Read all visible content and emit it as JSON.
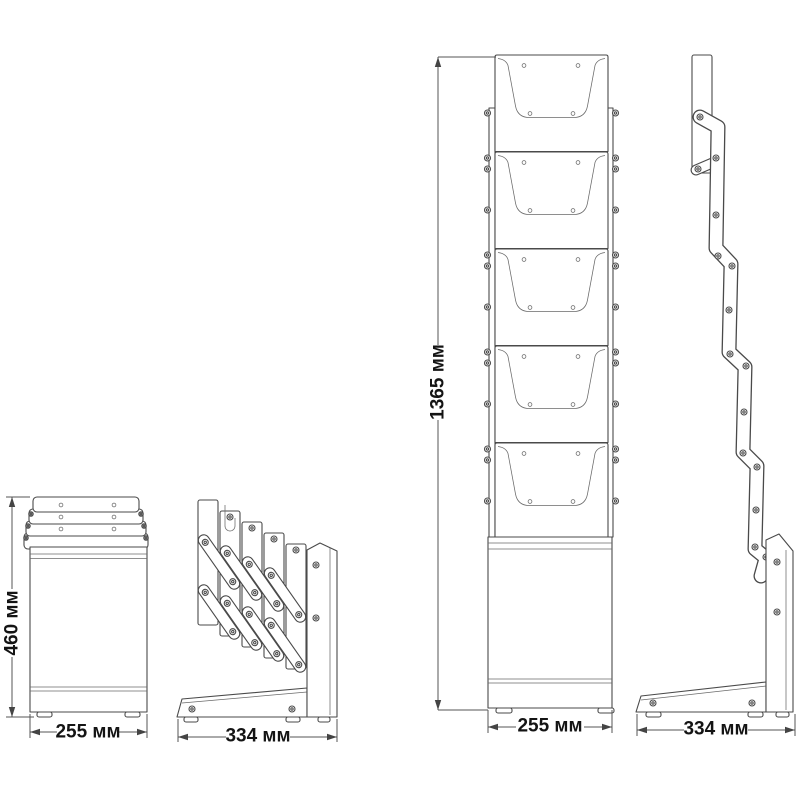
{
  "diagram": {
    "unit": "мм",
    "pockets_visible": 5,
    "dimensions": {
      "folded_height": "460 мм",
      "folded_front_width": "255 мм",
      "folded_side_depth": "334 мм",
      "open_height": "1365 мм",
      "open_front_width": "255 мм",
      "open_side_depth": "334 мм"
    },
    "colors": {
      "line": "#4a4a4a",
      "text": "#141414",
      "background": "#ffffff"
    }
  }
}
